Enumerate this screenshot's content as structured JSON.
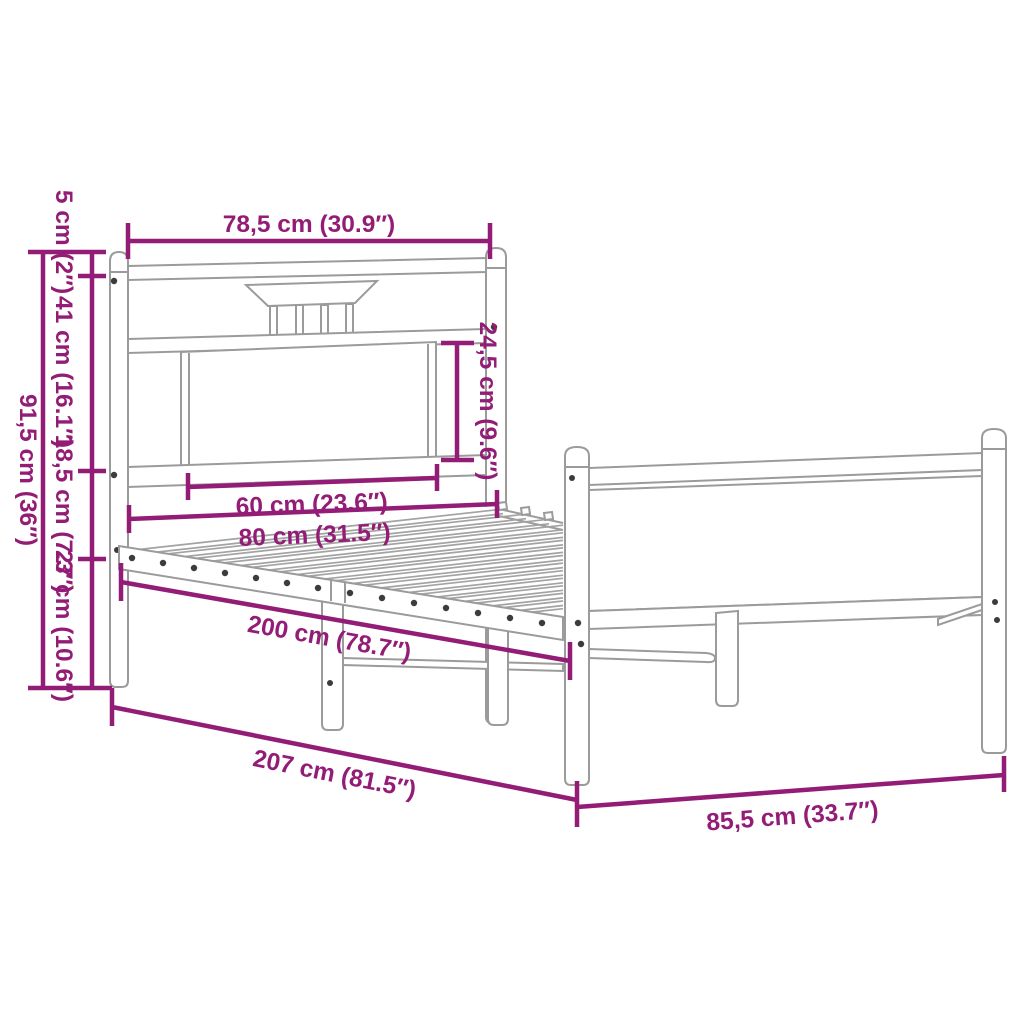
{
  "title": "Bed frame dimension diagram",
  "colors": {
    "dimension_annotation": "#931d76",
    "drawing_outline": "#9b9b9b",
    "background": "#ffffff"
  },
  "dims": {
    "headboard_width": "78,5 cm (30.9″)",
    "post_cap_height": "5 cm (2″)",
    "headboard_upper_height": "41 cm (16.1″)",
    "frame_rail_height": "18,5 cm (7.3″)",
    "underbed_clearance": "27 cm (10.6″)",
    "headboard_total_height": "91,5 cm (36″)",
    "headboard_panel_height": "24,5 cm (9.6″)",
    "headboard_panel_width": "60 cm (23.6″)",
    "bed_width": "80 cm (31.5″)",
    "sleeping_length": "200 cm (78.7″)",
    "total_length": "207 cm (81.5″)",
    "footboard_width": "85,5 cm (33.7″)"
  }
}
